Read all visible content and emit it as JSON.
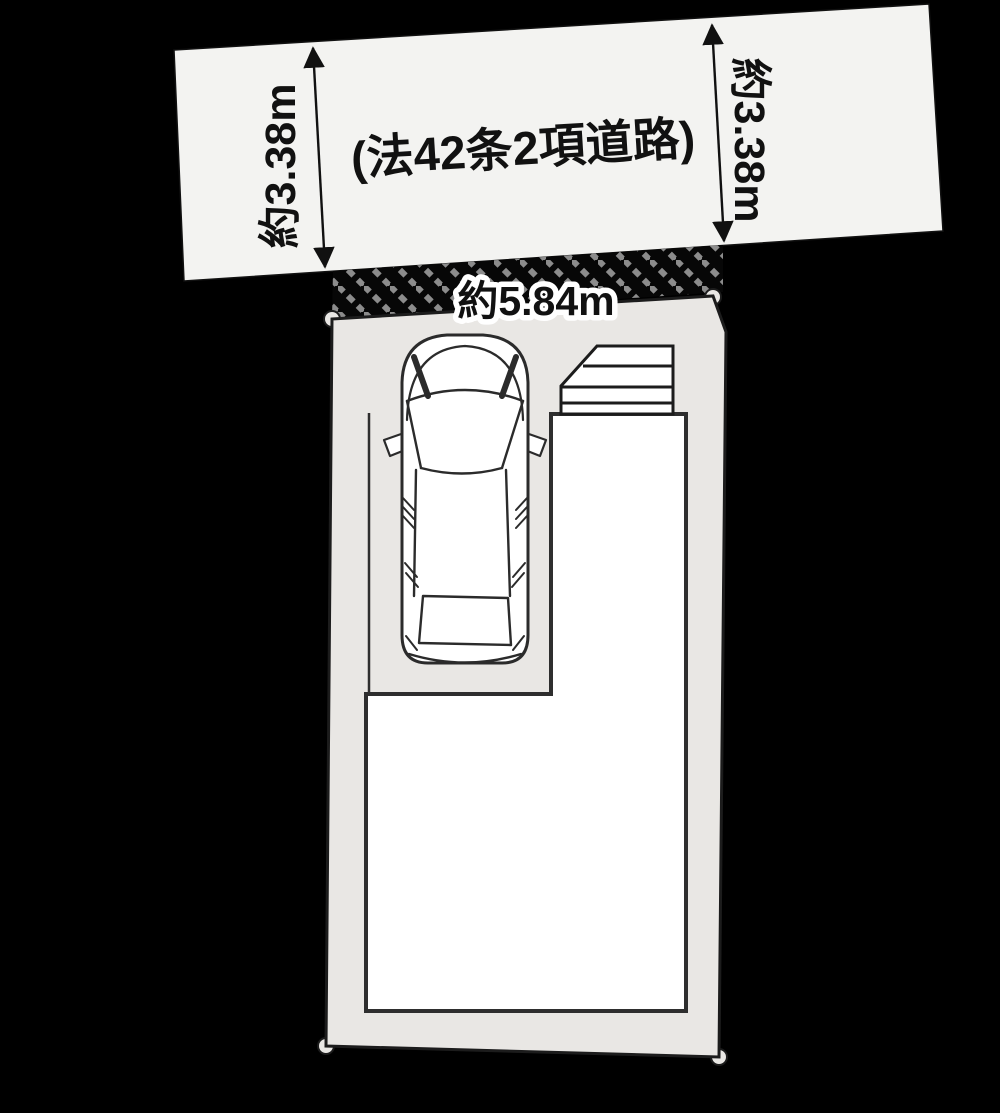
{
  "diagram": {
    "background": "#000000",
    "road": {
      "label": "(法42条2項道路)",
      "fill": "#f3f3f1",
      "width_left": "約3.38m",
      "width_right": "約3.38m"
    },
    "lot": {
      "fill": "#e9e7e4",
      "frontage": "約5.84m"
    },
    "building": {
      "fill": "#ffffff"
    },
    "car": {
      "fill": "#ffffff"
    },
    "colors": {
      "outline": "#1c1c1c",
      "building_line": "#2e2e2e",
      "car_line": "#2b2b2b",
      "dimension": "#111111",
      "hatch_dash": "#8c8c8c",
      "hatch_base": "#070707"
    }
  }
}
